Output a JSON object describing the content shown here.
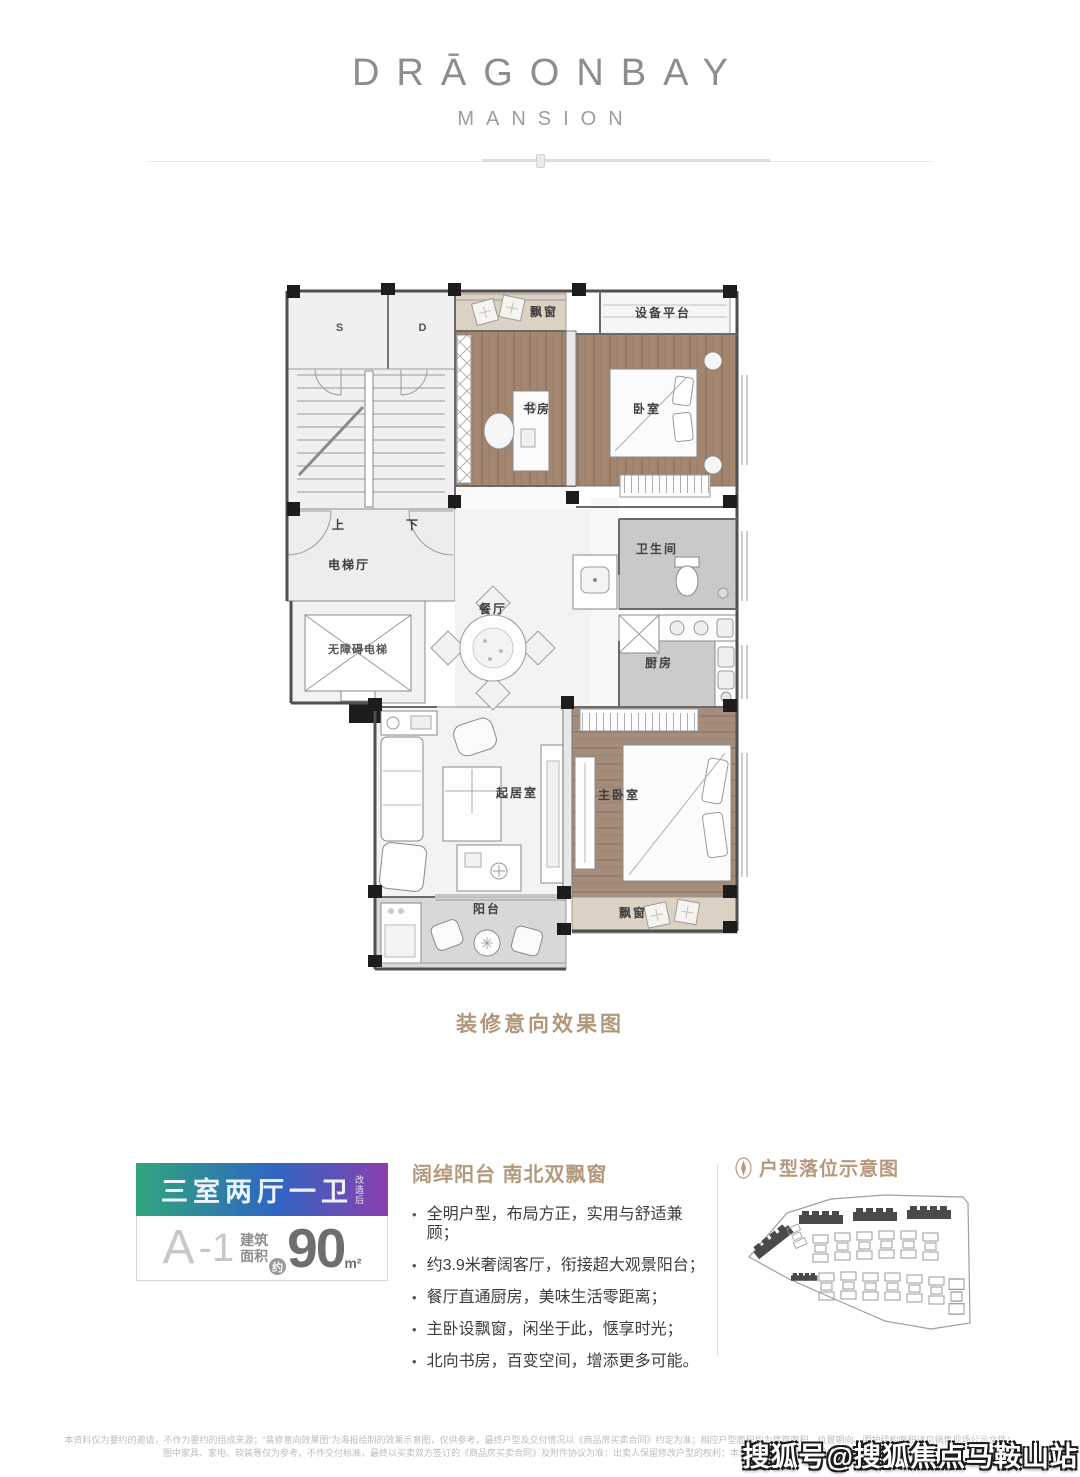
{
  "brand": {
    "name": "DRĀGONBAY",
    "subtitle": "MANSION"
  },
  "floorplan": {
    "caption": "装修意向效果图",
    "rooms": {
      "stair_s": "S",
      "stair_d": "D",
      "up": "上",
      "down": "下",
      "bay_top": "飘窗",
      "equipment": "设备平台",
      "study": "书房",
      "bedroom": "卧室",
      "elevator_hall": "电梯厅",
      "accessible_elevator": "无障碍电梯",
      "dining": "餐厅",
      "bathroom": "卫生间",
      "kitchen": "厨房",
      "living": "起居室",
      "master": "主卧室",
      "balcony": "阳台",
      "bay_bottom": "飘窗"
    }
  },
  "unit": {
    "layout": "三室两厅一卫",
    "layout_tag": "改造后",
    "model": "A",
    "model_suffix": "-1",
    "area_label_line1": "建筑",
    "area_label_line2": "面积",
    "area_approx": "约",
    "area_value": "90",
    "area_unit": "m²",
    "gradient_colors": [
      "#2fa67d",
      "#2f66c3",
      "#8a3fae"
    ]
  },
  "features": {
    "title": "阔绰阳台 南北双飘窗",
    "bullet": "•",
    "items": [
      "全明户型，布局方正，实用与舒适兼顾；",
      "约3.9米奢阔客厅，衔接超大观景阳台；",
      "餐厅直通厨房，美味生活零距离；",
      "主卧设飘窗，闲坐于此，惬享时光；",
      "北向书房，百变空间，增添更多可能。"
    ]
  },
  "sitemap": {
    "title": "户型落位示意图"
  },
  "disclaimer": {
    "line1": "本资料仅为要约的邀请，不作为要约的组成来源；“装修意向效果图”为海报绘制的效果示意图，仅供参考，最终户型及交付情况以《商品房买卖合同》约定为准；相应户型面积均为建筑面积，位置朝向、围护结构面积详见销售现场公示文件；",
    "line2": "图中家具、家电、软装等仅为参考，不作交付标准，最终以买卖双方签订的《商品房买卖合同》及附件协议为准；出卖人保留修改户型的权利；本资料发布于2020年7月，敬请留意最新资料。"
  },
  "watermark": "搜狐号@搜狐焦点马鞍山站",
  "colors": {
    "accent_title": "#b5997d",
    "wood_floor": "#a3866f",
    "stone_floor": "#c9c9cc",
    "bay_window": "#dcd2c3"
  }
}
